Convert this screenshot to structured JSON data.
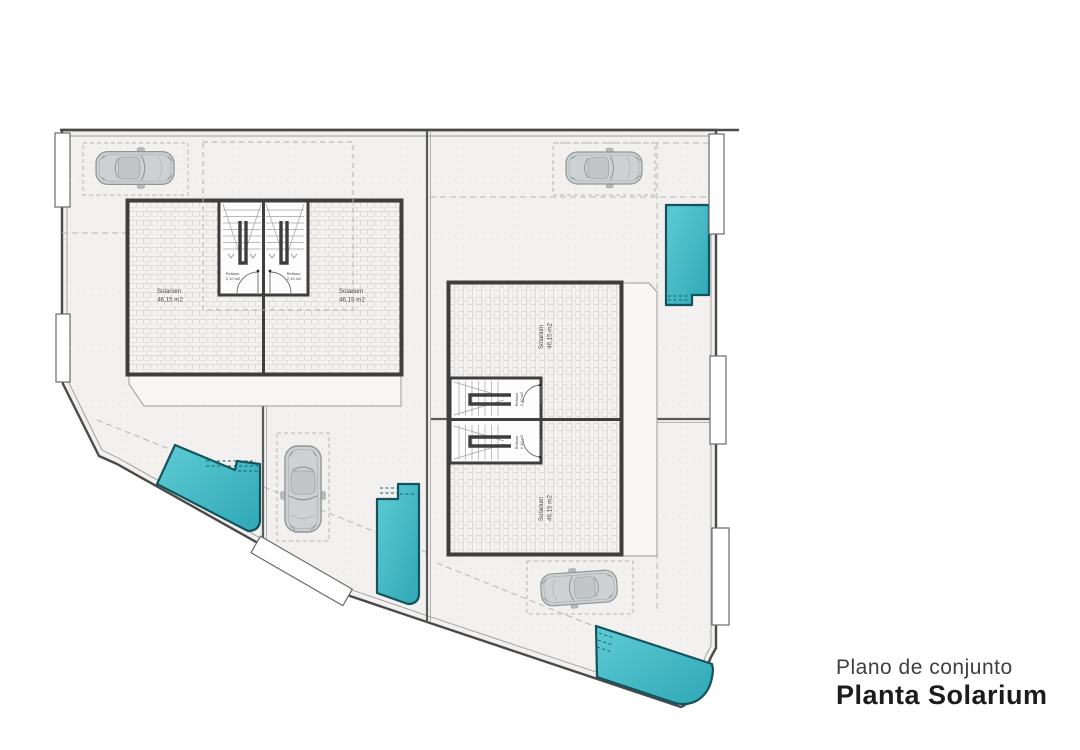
{
  "title": {
    "subtitle": "Plano de conjunto",
    "main": "Planta Solarium"
  },
  "colors": {
    "plot_fill": "#f2f1ef",
    "wall": "#3e3e3e",
    "pool_stroke": "#14525c",
    "pool_fill_light": "#5ecbd4",
    "pool_fill_dark": "#2fa8b6",
    "car_body": "#cdd1d2",
    "car_line": "#99a0a2"
  },
  "units": [
    {
      "id": "1",
      "room": "Solarium",
      "area": "46,15 m2",
      "landing": "Rellano",
      "landing_area": "2,10 m2"
    },
    {
      "id": "2",
      "room": "Solarium",
      "area": "46,15 m2",
      "landing": "Rellano",
      "landing_area": "2,10 m2"
    },
    {
      "id": "3",
      "room": "Solarium",
      "area": "46,15 m2",
      "landing": "Rellano",
      "landing_area": "2,10 m2"
    },
    {
      "id": "4",
      "room": "Solarium",
      "area": "46,15 m2",
      "landing": "Rellano",
      "landing_area": "2,10 m2"
    }
  ]
}
